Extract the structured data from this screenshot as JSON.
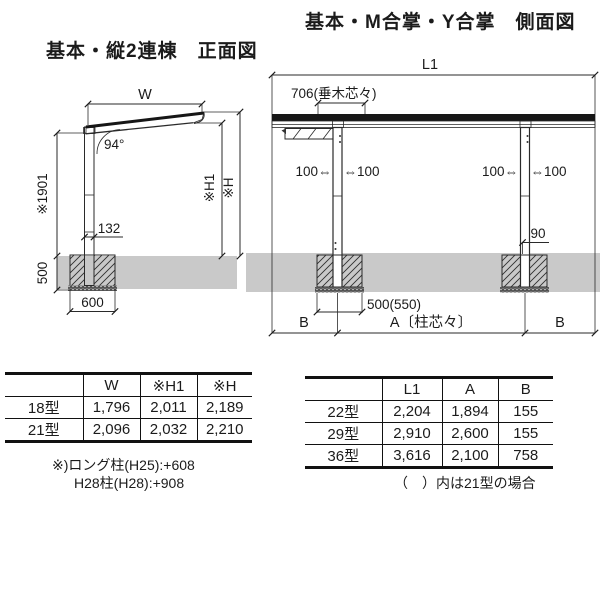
{
  "front_view": {
    "title": "基本・縦2連棟　正面図",
    "labels": {
      "width": "W",
      "angle": "94°",
      "column_height": "※1901",
      "h1": "※H1",
      "h": "※H",
      "column_depth": "132",
      "footing_depth": "500",
      "footing_width": "600"
    }
  },
  "side_view": {
    "title": "基本・M合掌・Y合掌　側面図",
    "labels": {
      "l1": "L1",
      "rafter_pitch": "706(垂木芯々)",
      "offset_left_outer": "100⇔",
      "offset_left_inner": "⇔100",
      "offset_right_outer": "100⇔",
      "offset_right_inner": "⇔100",
      "beam_offset": "90",
      "footing_width": "500(550)",
      "span_b_left": "B",
      "span_a": "A〔柱芯々〕",
      "span_b_right": "B"
    }
  },
  "size_table": {
    "headers": [
      "",
      "W",
      "※H1",
      "※H"
    ],
    "rows": [
      {
        "label": "18型",
        "values": [
          "1,796",
          "2,011",
          "2,189"
        ]
      },
      {
        "label": "21型",
        "values": [
          "2,096",
          "2,032",
          "2,210"
        ]
      }
    ],
    "note1": "※)ロング柱(H25):+608",
    "note2": "H28柱(H28):+908"
  },
  "length_table": {
    "headers": [
      "",
      "L1",
      "A",
      "B"
    ],
    "rows": [
      {
        "label": "22型",
        "values": [
          "2,204",
          "1,894",
          "155"
        ]
      },
      {
        "label": "29型",
        "values": [
          "2,910",
          "2,600",
          "155"
        ]
      },
      {
        "label": "36型",
        "values": [
          "3,616",
          "2,100",
          "758"
        ]
      }
    ],
    "note": "（　）内は21型の場合"
  },
  "colors": {
    "line": "#2a2a2a",
    "ground_fill": "#c9c9c9",
    "column_fill": "#9e9e9e",
    "roof_dark": "#161616",
    "panel_fill": "#f0f0f0",
    "gravel_fill": "#505050"
  }
}
